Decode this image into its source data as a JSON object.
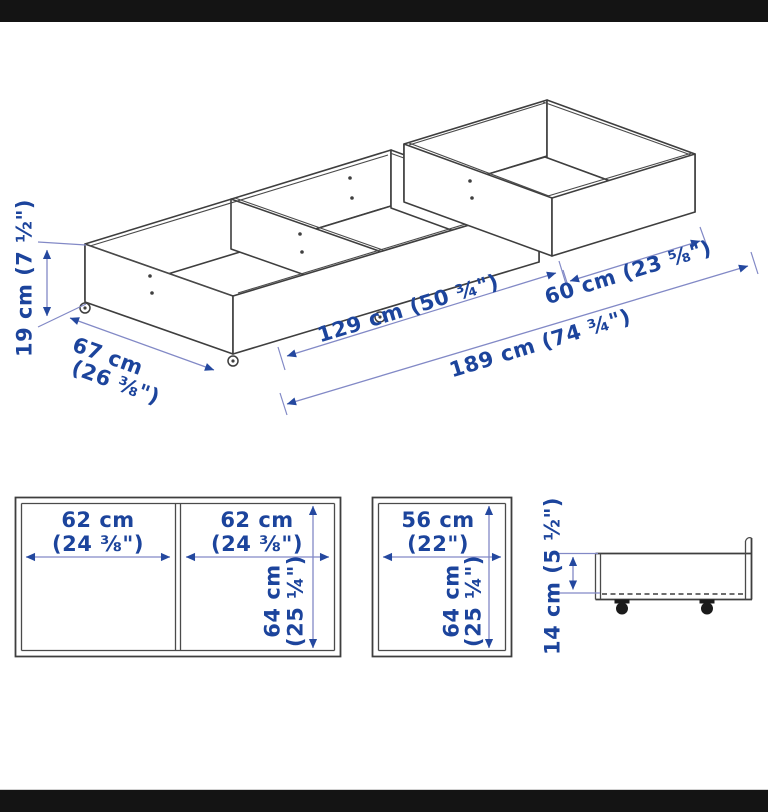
{
  "colors": {
    "label_blue": "#1c449c",
    "dimension_line": "#8289c6",
    "arrowhead": "#24489f",
    "outline": "#3e3e3e",
    "letterbox_bar": "#141414",
    "background": "#ffffff"
  },
  "iso_view": {
    "height_label": "19 cm (7 ½\")",
    "width_label_line1": "67 cm",
    "width_label_line2": "(26 ⅜\")",
    "large_box_length_label": "129 cm (50 ¾\")",
    "small_box_length_label": "60 cm (23 ⅝\")",
    "total_length_label": "189 cm (74 ¾\")"
  },
  "top_view_large_box": {
    "compartment1_width_line1": "62 cm",
    "compartment1_width_line2": "(24 ⅜\")",
    "compartment2_width_line1": "62 cm",
    "compartment2_width_line2": "(24 ⅜\")",
    "depth_line1": "64 cm",
    "depth_line2": "(25 ¼\")"
  },
  "top_view_small_box": {
    "width_line1": "56 cm",
    "width_line2": "(22\")",
    "depth_line1": "64 cm",
    "depth_line2": "(25 ¼\")"
  },
  "side_view": {
    "height_label": "14 cm (5 ½\")"
  }
}
